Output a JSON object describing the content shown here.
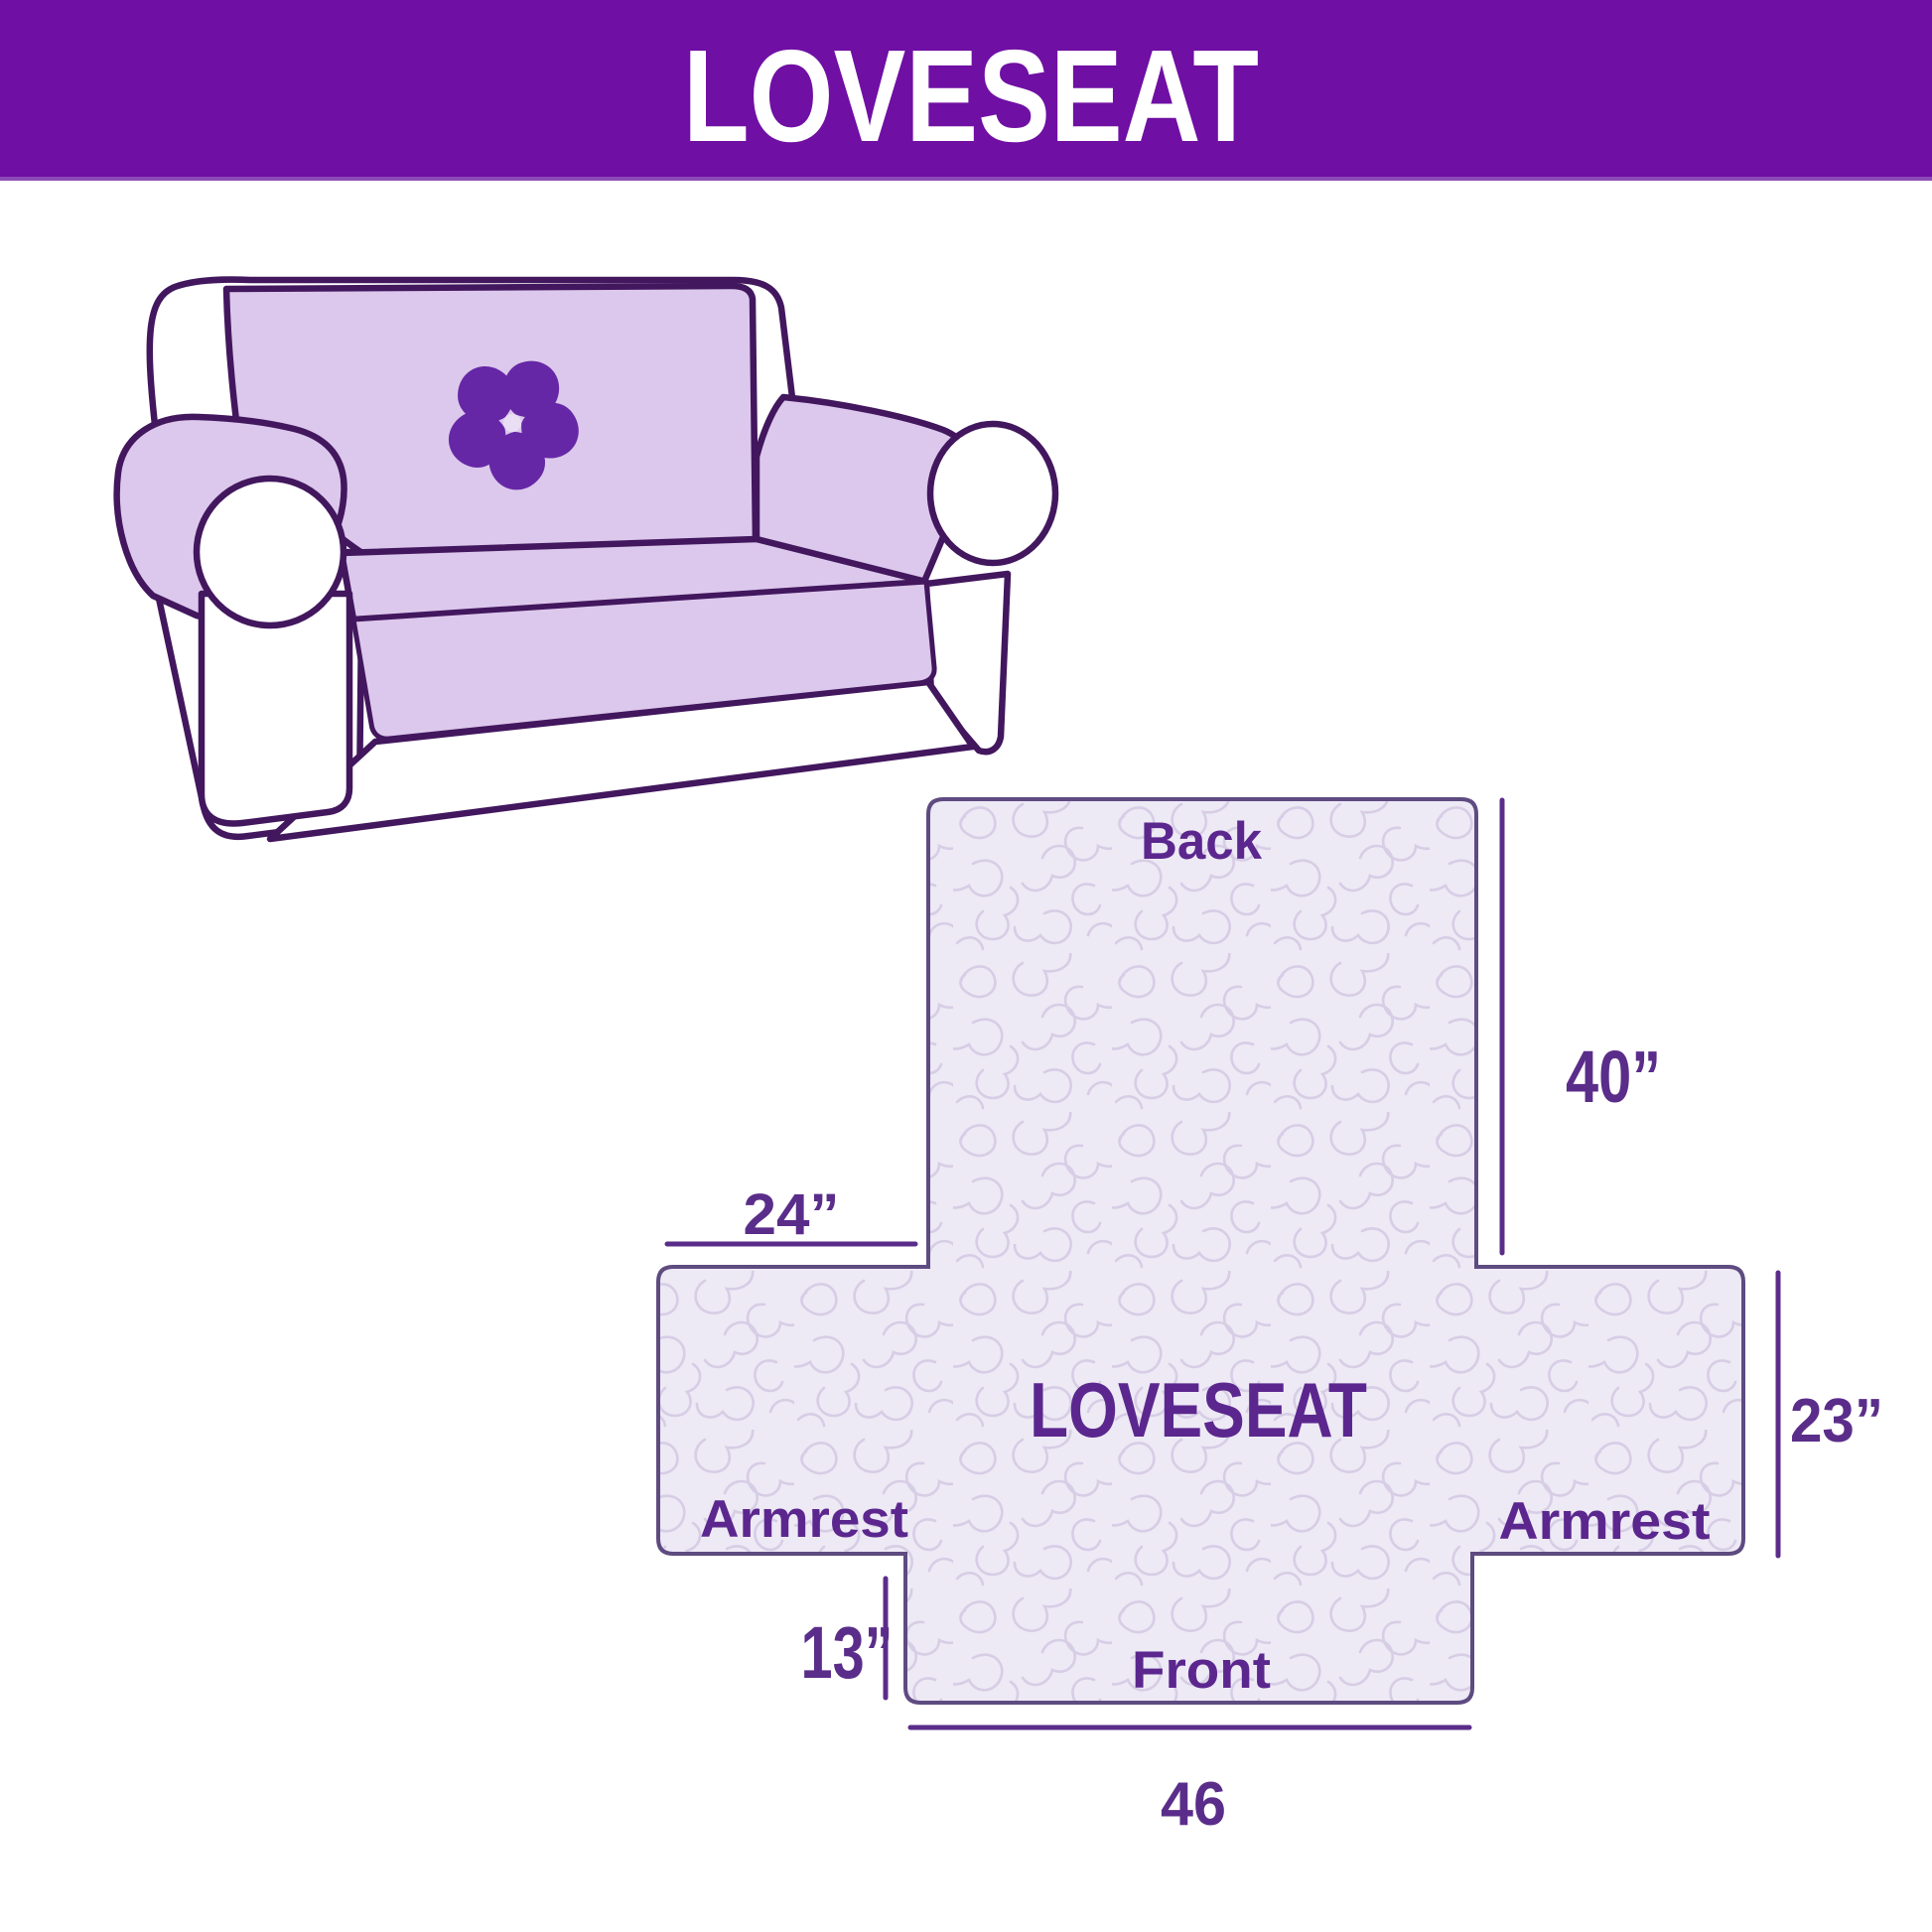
{
  "header": {
    "title": "LOVESEAT"
  },
  "illustration": {
    "subject": "loveseat sofa with slipcover",
    "logo_icon": "pinwheel-flower-icon"
  },
  "diagram": {
    "product_label": "LOVESEAT",
    "panels": {
      "back": "Back",
      "armrest_left": "Armrest",
      "armrest_right": "Armrest",
      "front": "Front"
    },
    "dimensions": {
      "back_height": "40”",
      "armrest_width": "24”",
      "armrest_height": "23”",
      "front_skirt_height": "13”",
      "front_width": "46"
    },
    "colors": {
      "header_bg": "#6f0fa3",
      "header_text": "#ffffff",
      "label_text": "#5b278e",
      "dimension_line": "#5b2d8a",
      "fabric_outline": "#5e4b80",
      "fabric_fill": "#ede9f5",
      "quilt_pattern": "#d7cde5",
      "sofa_outline": "#42175e",
      "sofa_cover": "#dcc8ec",
      "logo": "#6627a6"
    }
  }
}
